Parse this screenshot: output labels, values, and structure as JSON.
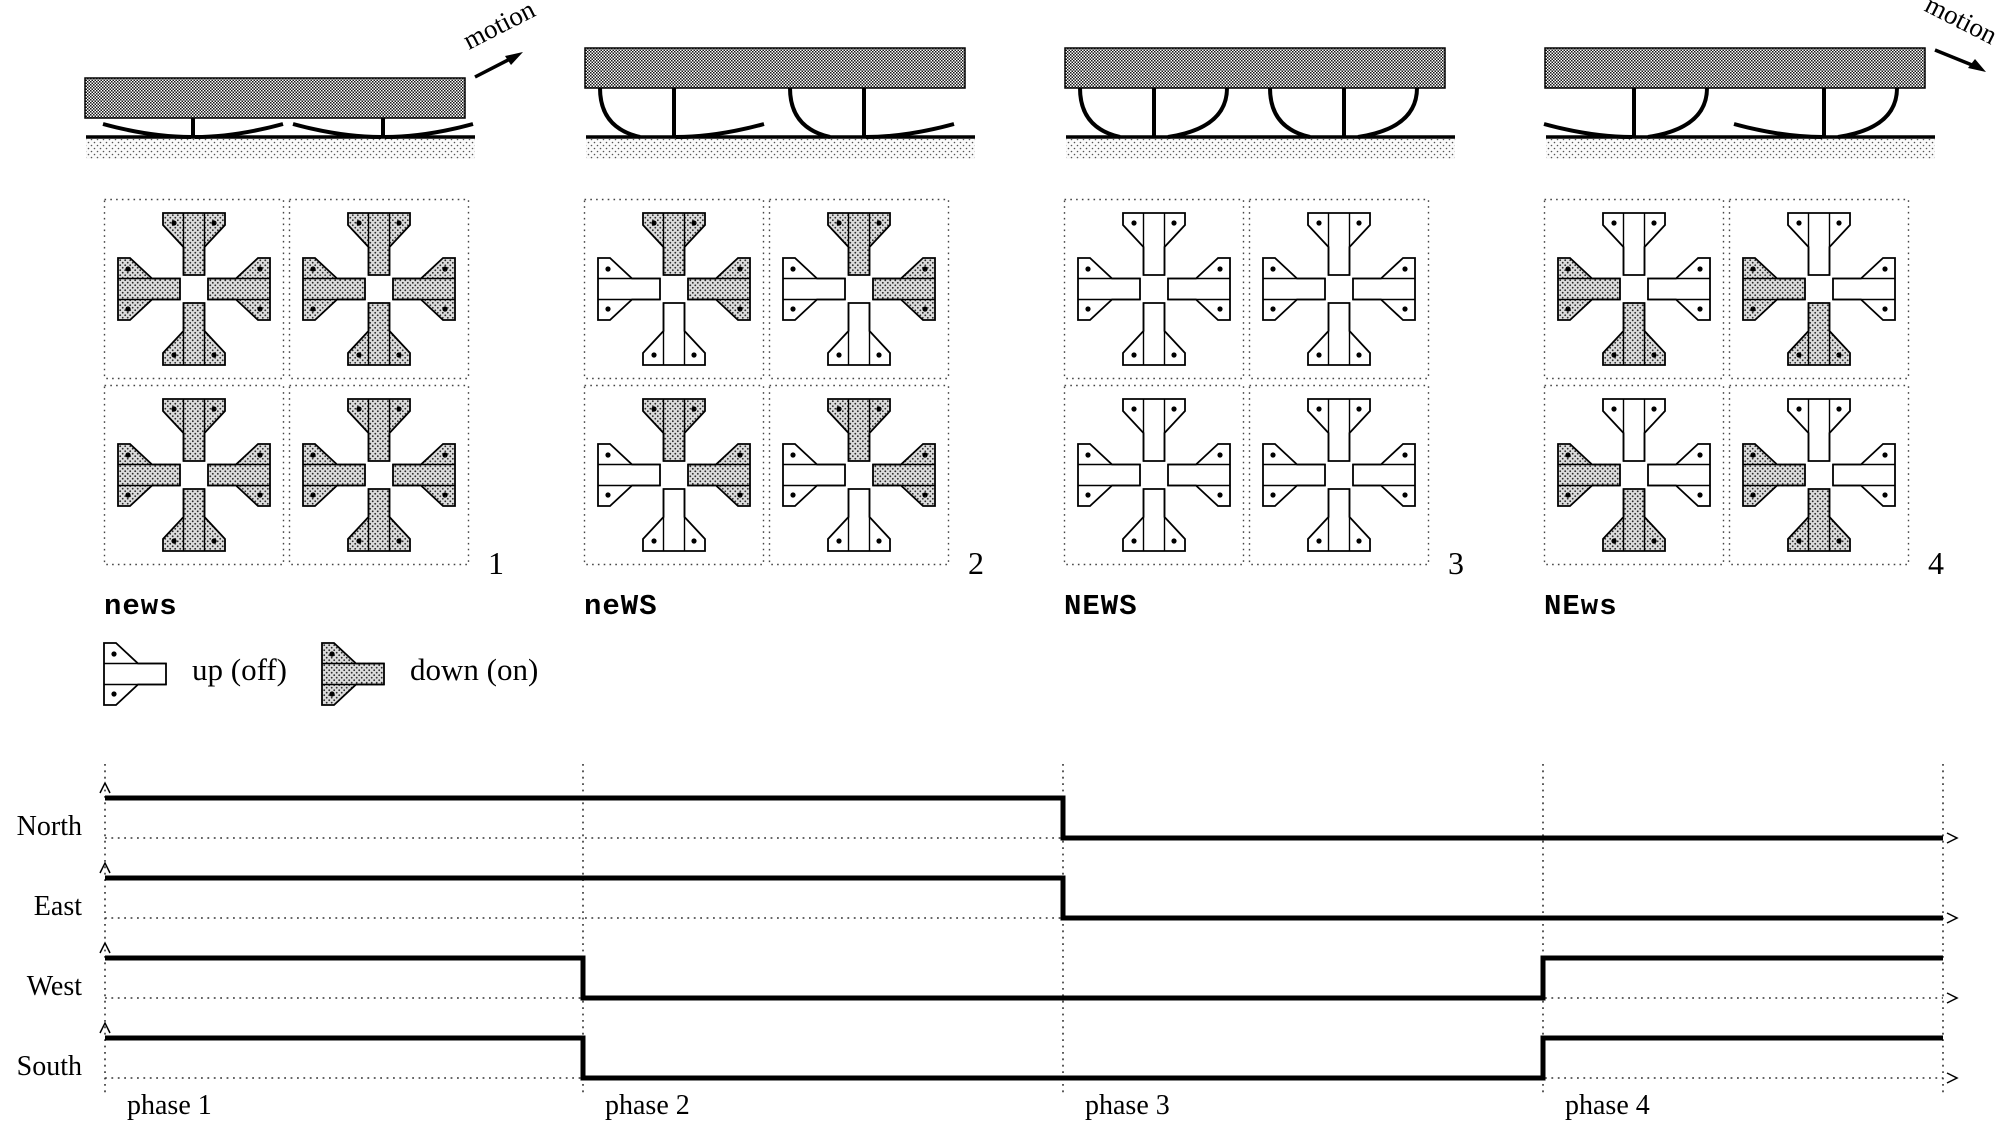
{
  "figure": {
    "motion_label": "motion",
    "legend": {
      "up_label": "up (off)",
      "down_label": "down (on)"
    },
    "phases": [
      {
        "number": "1",
        "label": "news",
        "arms": {
          "north": "down",
          "east": "down",
          "west": "down",
          "south": "down"
        },
        "side_view": {
          "left_cilium": "flat",
          "right_cilium": "flat",
          "motion": "up-right"
        }
      },
      {
        "number": "2",
        "label": "neWS",
        "arms": {
          "north": "down",
          "east": "down",
          "west": "up",
          "south": "up"
        },
        "side_view": {
          "left_cilium": "curl",
          "right_cilium": "flat",
          "motion": null
        }
      },
      {
        "number": "3",
        "label": "NEWS",
        "arms": {
          "north": "up",
          "east": "up",
          "west": "up",
          "south": "up"
        },
        "side_view": {
          "left_cilium": "curl",
          "right_cilium": "curl",
          "motion": null
        }
      },
      {
        "number": "4",
        "label": "NEws",
        "arms": {
          "north": "up",
          "east": "up",
          "west": "down",
          "south": "down"
        },
        "side_view": {
          "left_cilium": "flat",
          "right_cilium": "curl",
          "motion": "down-right"
        }
      }
    ]
  },
  "chart_data": {
    "type": "line",
    "subtype": "digital-timing-diagram",
    "x_phases": [
      "phase 1",
      "phase 2",
      "phase 3",
      "phase 4"
    ],
    "signals": [
      {
        "name": "North",
        "levels_by_phase": [
          1,
          1,
          0,
          0
        ]
      },
      {
        "name": "East",
        "levels_by_phase": [
          1,
          1,
          0,
          0
        ]
      },
      {
        "name": "West",
        "levels_by_phase": [
          1,
          0,
          0,
          1
        ]
      },
      {
        "name": "South",
        "levels_by_phase": [
          1,
          0,
          0,
          1
        ]
      }
    ],
    "high_meaning": "down (on)",
    "low_meaning": "up (off)",
    "grid": "dotted phase boundaries and dotted baselines with axis arrows"
  }
}
